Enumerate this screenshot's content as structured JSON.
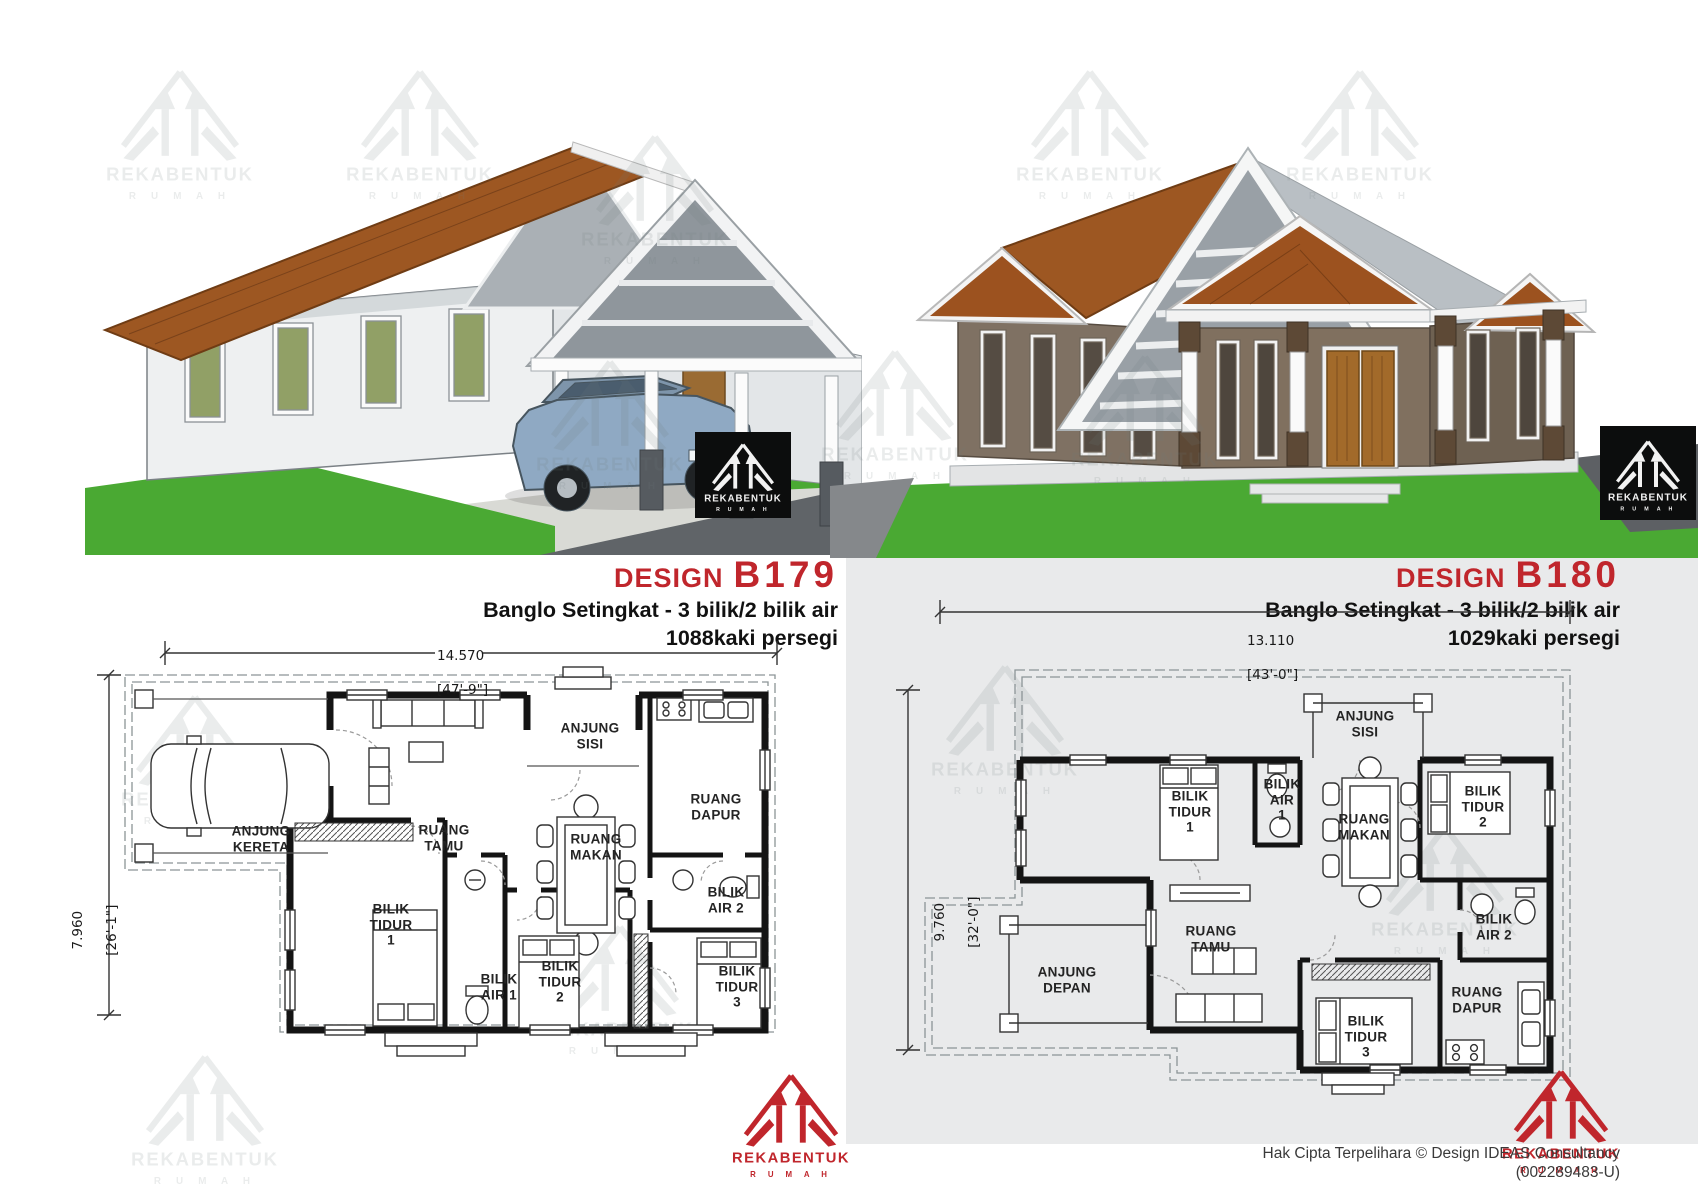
{
  "brand": {
    "name": "REKABENTUK",
    "sub": "R U M A H",
    "red": "#c0262c"
  },
  "page": {
    "panel_gray": "#e9eaeb",
    "grass_green": "#4aa933",
    "roof_terracotta": "#9c5520",
    "wall_taupe": "#7f7163",
    "car_blue": "#8fa9c3"
  },
  "b179": {
    "design_label": "DESIGN",
    "code": "B179",
    "subtitle": "Banglo Setingkat - 3 bilik/2 bilik air",
    "area": "1088kaki persegi",
    "dim_top_m": "14.570",
    "dim_top_ft": "[47'-9\"]",
    "dim_left_m": "7.960",
    "dim_left_ft": "[26'-1\"]",
    "rooms": {
      "anjung_kereta": "ANJUNG\nKERETA",
      "ruang_tamu": "RUANG\nTAMU",
      "anjung_sisi": "ANJUNG\nSISI",
      "ruang_dapur": "RUANG\nDAPUR",
      "ruang_makan": "RUANG\nMAKAN",
      "bilik_tidur_1": "BILIK\nTIDUR\n1",
      "bilik_air_1": "BILIK\nAIR 1",
      "bilik_tidur_2": "BILIK\nTIDUR\n2",
      "bilik_air_2": "BILIK\nAIR 2",
      "bilik_tidur_3": "BILIK\nTIDUR\n3"
    }
  },
  "b180": {
    "design_label": "DESIGN",
    "code": "B180",
    "subtitle": "Banglo Setingkat - 3 bilik/2 bilik air",
    "area": "1029kaki persegi",
    "dim_top_m": "13.110",
    "dim_top_ft": "[43'-0\"]",
    "dim_left_m": "9.760",
    "dim_left_ft": "[32'-0\"]",
    "rooms": {
      "anjung_sisi": "ANJUNG\nSISI",
      "bilik_tidur_1": "BILIK\nTIDUR\n1",
      "bilik_air_1": "BILIK\nAIR\n1",
      "ruang_makan": "RUANG\nMAKAN",
      "bilik_tidur_2": "BILIK\nTIDUR\n2",
      "anjung_depan": "ANJUNG\nDEPAN",
      "ruang_tamu": "RUANG\nTAMU",
      "bilik_tidur_3": "BILIK\nTIDUR\n3",
      "ruang_dapur": "RUANG\nDAPUR",
      "bilik_air_2": "BILIK\nAIR 2"
    }
  },
  "footer": {
    "line1": "Hak Cipta Terpelihara  © Design IDEAS Consultancy",
    "line2": "(002289483-U)"
  }
}
